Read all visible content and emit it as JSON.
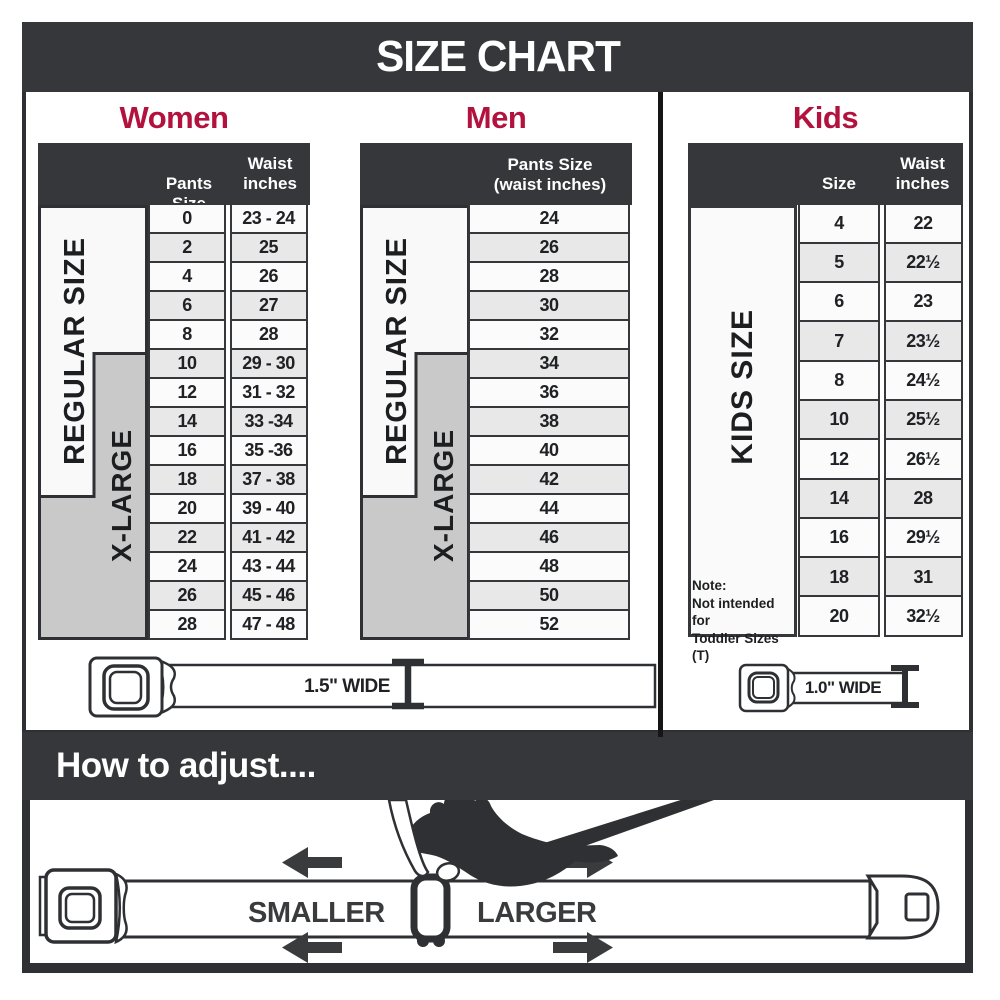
{
  "title": "SIZE CHART",
  "colors": {
    "accent_red": "#b2123d",
    "dark_bar": "#35373a",
    "xlarge_gray": "#c9c9c9"
  },
  "women": {
    "heading": "Women",
    "col1_header": "Pants Size",
    "col2_header": "Waist inches",
    "regular_label": "REGULAR SIZE",
    "xlarge_label": "X-LARGE",
    "rows": [
      {
        "size": "0",
        "waist": "23 - 24"
      },
      {
        "size": "2",
        "waist": "25"
      },
      {
        "size": "4",
        "waist": "26"
      },
      {
        "size": "6",
        "waist": "27"
      },
      {
        "size": "8",
        "waist": "28"
      },
      {
        "size": "10",
        "waist": "29 - 30"
      },
      {
        "size": "12",
        "waist": "31 - 32"
      },
      {
        "size": "14",
        "waist": "33 -34"
      },
      {
        "size": "16",
        "waist": "35 -36"
      },
      {
        "size": "18",
        "waist": "37 - 38"
      },
      {
        "size": "20",
        "waist": "39 - 40"
      },
      {
        "size": "22",
        "waist": "41 - 42"
      },
      {
        "size": "24",
        "waist": "43 - 44"
      },
      {
        "size": "26",
        "waist": "45 - 46"
      },
      {
        "size": "28",
        "waist": "47 - 48"
      }
    ]
  },
  "men": {
    "heading": "Men",
    "col_header_line1": "Pants Size",
    "col_header_line2": "(waist inches)",
    "regular_label": "REGULAR SIZE",
    "xlarge_label": "X-LARGE",
    "rows": [
      "24",
      "26",
      "28",
      "30",
      "32",
      "34",
      "36",
      "38",
      "40",
      "42",
      "44",
      "46",
      "48",
      "50",
      "52"
    ]
  },
  "kids": {
    "heading": "Kids",
    "col1_header": "Size",
    "col2_header": "Waist inches",
    "side_label": "KIDS SIZE",
    "note_line1": "Note:",
    "note_line2": "Not intended for",
    "note_line3": "Toddler Sizes (T)",
    "rows": [
      {
        "size": "4",
        "waist": "22"
      },
      {
        "size": "5",
        "waist": "22½"
      },
      {
        "size": "6",
        "waist": "23"
      },
      {
        "size": "7",
        "waist": "23½"
      },
      {
        "size": "8",
        "waist": "24½"
      },
      {
        "size": "10",
        "waist": "25½"
      },
      {
        "size": "12",
        "waist": "26½"
      },
      {
        "size": "14",
        "waist": "28"
      },
      {
        "size": "16",
        "waist": "29½"
      },
      {
        "size": "18",
        "waist": "31"
      },
      {
        "size": "20",
        "waist": "32½"
      }
    ]
  },
  "belts": {
    "adult_width_label": "1.5\" WIDE",
    "kids_width_label": "1.0\" WIDE"
  },
  "how_to_adjust": {
    "heading": "How to adjust....",
    "smaller": "SMALLER",
    "larger": "LARGER"
  }
}
